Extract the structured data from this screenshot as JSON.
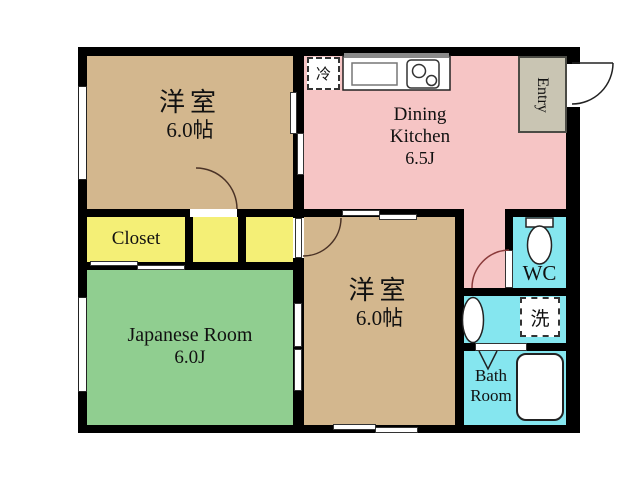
{
  "rooms": {
    "western_room_top": {
      "name": "洋室",
      "area": "6.0帖"
    },
    "dining_kitchen": {
      "name_line1": "Dining",
      "name_line2": "Kitchen",
      "area": "6.5J"
    },
    "entry": {
      "label": "Entry"
    },
    "closet": {
      "label": "Closet"
    },
    "japanese_room": {
      "name": "Japanese Room",
      "area": "6.0J"
    },
    "western_room_bottom": {
      "name": "洋室",
      "area": "6.0帖"
    },
    "wc": {
      "label": "WC"
    },
    "bath_room": {
      "name_line1": "Bath",
      "name_line2": "Room"
    },
    "laundry": {
      "label": "洗"
    },
    "refrigerator": {
      "label": "冷"
    }
  },
  "colors": {
    "wall": "#000000",
    "western_room": "#D3B78E",
    "dining_kitchen": "#F6C5C5",
    "closet": "#F4EF76",
    "japanese_room": "#90CE90",
    "wet_area": "#85E6EF",
    "entry": "#C9C5B3",
    "fixture": "#FFFFFF"
  }
}
